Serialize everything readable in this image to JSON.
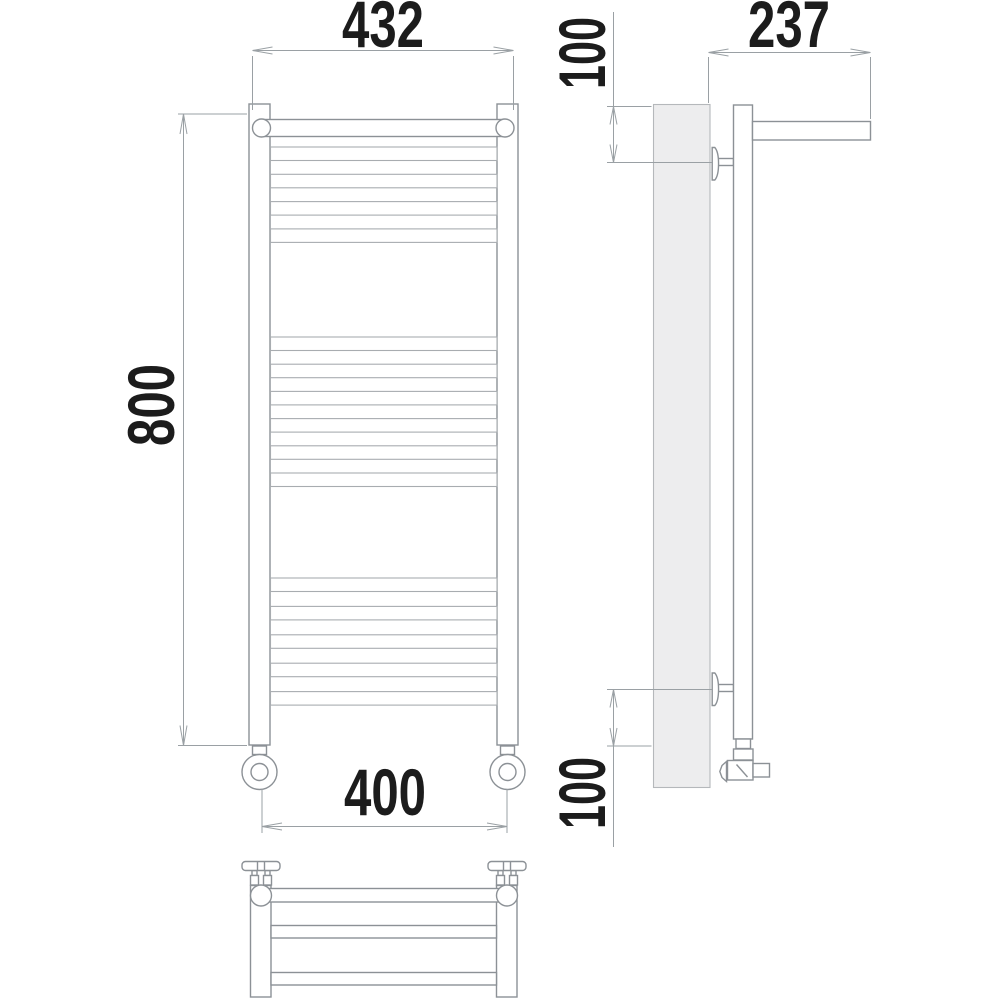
{
  "dims": {
    "width_overall": "432",
    "height": "800",
    "connection_spacing": "400",
    "depth": "237",
    "top_bracket_offset": "100",
    "bottom_bracket_offset": "100"
  },
  "colors": {
    "line": "#8c9196",
    "line2": "#a8acb0",
    "dim": "#9aa0a4",
    "txt": "#1c1c1c",
    "panel": "#ededee",
    "bg": "#ffffff"
  }
}
